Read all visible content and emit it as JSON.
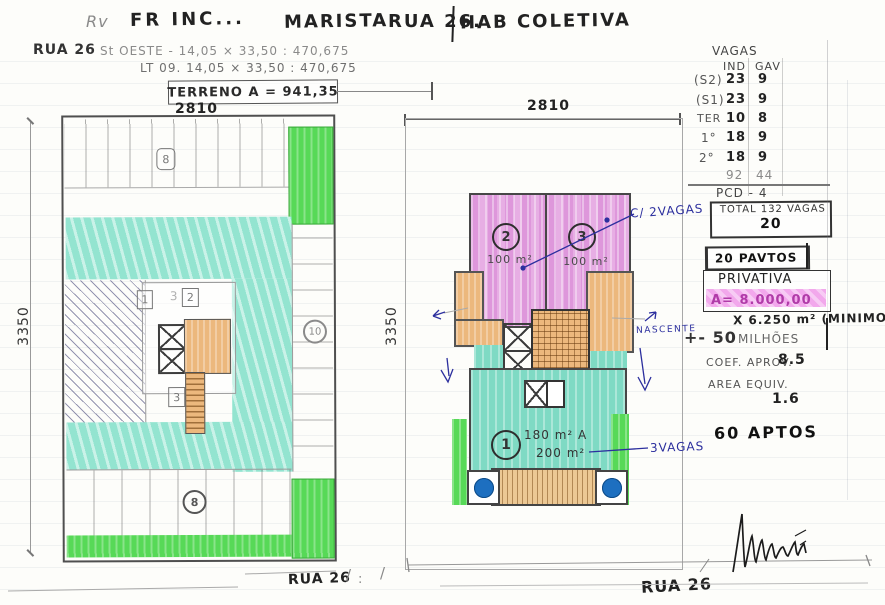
{
  "header": {
    "initials": "Rv",
    "firm": "FR INC...",
    "district": "MARISTA",
    "street": "RUA 26.",
    "project_type": "HAB COLETIVA"
  },
  "site": {
    "street": "RUA 26",
    "sector_line": "St OESTE - 14,05 × 33,50 : 470,675",
    "lot_line": "LT 09. 14,05 × 33,50 : 470,675",
    "terreno": "TERRENO A = 941,35"
  },
  "dims": {
    "left_top": "2810",
    "left_side": "3350",
    "right_top": "2810",
    "right_side": "3350"
  },
  "left_plan": {
    "top_tag": "8",
    "room1_tag": "1",
    "room3_faint": "3",
    "room2_tag": "2",
    "room3_tag": "3",
    "right_circle": "10",
    "bottom_circle": "8",
    "street_label": "RUA 26"
  },
  "right_plan": {
    "unit2_num": "2",
    "unit2_area": "100 m²",
    "unit3_num": "3",
    "unit3_area": "100 m²",
    "unit1_num": "1",
    "unit1_area_a": "180 m² A",
    "unit1_area_b": "200 m²",
    "ann_vagas2": "C/ 2VAGAS",
    "ann_nascente": "NASCENTE",
    "ann_vagas3": "3VAGAS",
    "street_label": "RUA 26",
    "mark_slash1": "/",
    "mark_colon": ":",
    "mark_slash2": "/"
  },
  "vagas": {
    "title": "VAGAS",
    "col_ind": "IND",
    "col_gav": "GAV",
    "rows": [
      {
        "level": "(S2)",
        "ind": "23",
        "gav": "9"
      },
      {
        "level": "(S1)",
        "ind": "23",
        "gav": "9"
      },
      {
        "level": "TER",
        "ind": "10",
        "gav": "8"
      },
      {
        "level": "1°",
        "ind": "18",
        "gav": "9"
      },
      {
        "level": "2°",
        "ind": "18",
        "gav": "9"
      }
    ],
    "total_ind": "92",
    "total_gav": "44",
    "pcd_line": "PCD - 4",
    "total_line": "TOTAL 132 VAGAS",
    "per_floor": "20"
  },
  "summary": {
    "pavtos": "20 PAVTOS",
    "privativa_label": "PRIVATIVA",
    "privativa_area": "A= 8.000,00",
    "minimo": "X 6.250 m² (MINIMO)",
    "valor_prefix": "+- 50",
    "valor_suffix": "MILHÕES",
    "coef_label": "COEF. APROV.",
    "coef_value": "8.5",
    "area_equiv_label": "AREA EQUIV.",
    "area_equiv_value": "1.6",
    "aptos": "60 APTOS"
  },
  "colors": {
    "pencil": "#8a8a8a",
    "ink_blue": "#2c2f9e",
    "marker_pink": "#e7aee4",
    "marker_teal": "#7fdac4",
    "marker_green": "#57d957",
    "marker_orange": "#ecb87d",
    "tree_blue": "#1d6fc0",
    "highlight_pink": "#f2a8ec"
  }
}
